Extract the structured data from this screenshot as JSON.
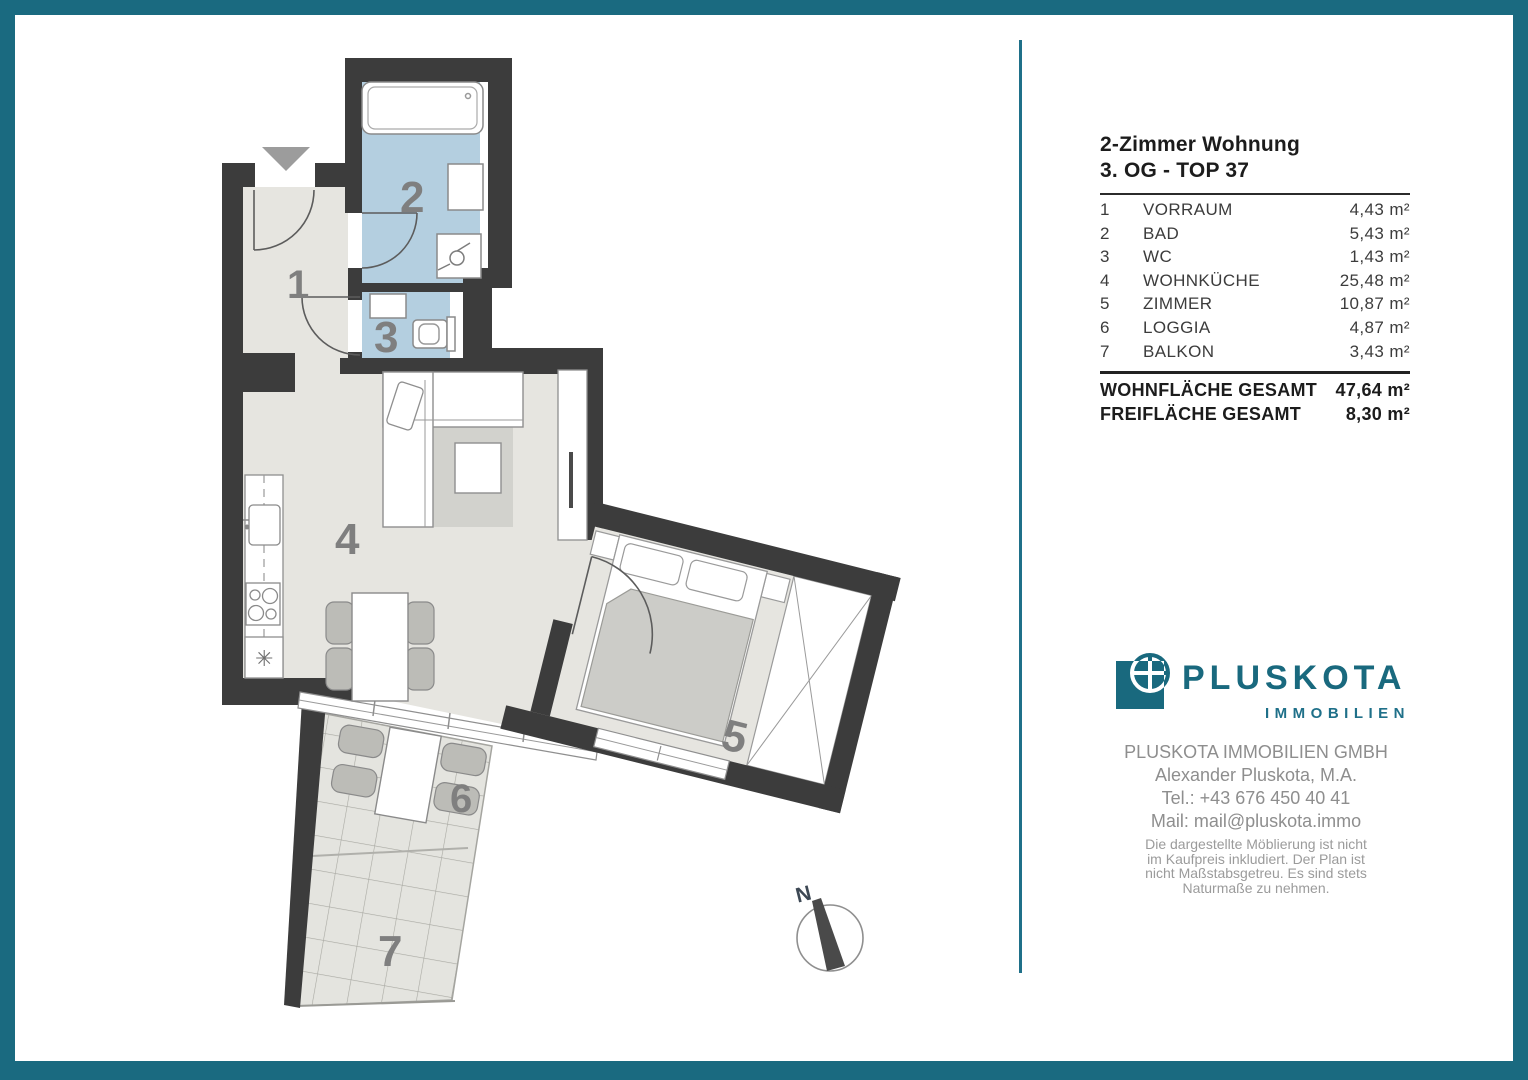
{
  "panel": {
    "title_line1": "2-Zimmer Wohnung",
    "title_line2": "3. OG - TOP 37",
    "rooms": [
      {
        "nr": "1",
        "name": "VORRAUM",
        "area": "4,43 m²"
      },
      {
        "nr": "2",
        "name": "BAD",
        "area": "5,43 m²"
      },
      {
        "nr": "3",
        "name": "WC",
        "area": "1,43 m²"
      },
      {
        "nr": "4",
        "name": "WOHNKÜCHE",
        "area": "25,48 m²"
      },
      {
        "nr": "5",
        "name": "ZIMMER",
        "area": "10,87 m²"
      },
      {
        "nr": "6",
        "name": "LOGGIA",
        "area": "4,87 m²"
      },
      {
        "nr": "7",
        "name": "BALKON",
        "area": "3,43 m²"
      }
    ],
    "totals": [
      {
        "label": "WOHNFLÄCHE GESAMT",
        "value": "47,64 m²"
      },
      {
        "label": "FREIFLÄCHE GESAMT",
        "value": "8,30 m²"
      }
    ],
    "logo": {
      "main": "PLUSKOTA",
      "sub": "IMMOBILIEN"
    },
    "contact": {
      "company": "PLUSKOTA IMMOBILIEN GMBH",
      "person": "Alexander Pluskota, M.A.",
      "tel": "Tel.: +43 676 450 40 41",
      "mail": "Mail: mail@pluskota.immo"
    },
    "disclaimer": [
      "Die dargestellte Möblierung ist nicht",
      "im Kaufpreis inkludiert. Der Plan ist",
      "nicht Maßstabsgetreu. Es sind stets",
      "Naturmaße zu nehmen."
    ]
  },
  "floorplan": {
    "labels": {
      "r1": "1",
      "r2": "2",
      "r3": "3",
      "r4": "4",
      "r5": "5",
      "r6": "6",
      "r7": "7",
      "north": "N"
    },
    "colors": {
      "accent_teal": "#1a6a80",
      "logo_teal": "#19697e",
      "wall": "#3c3c3c",
      "floor": "#e6e5e0",
      "wet_room": "#b4cfe0",
      "room_label": "#7f7f7f"
    }
  }
}
